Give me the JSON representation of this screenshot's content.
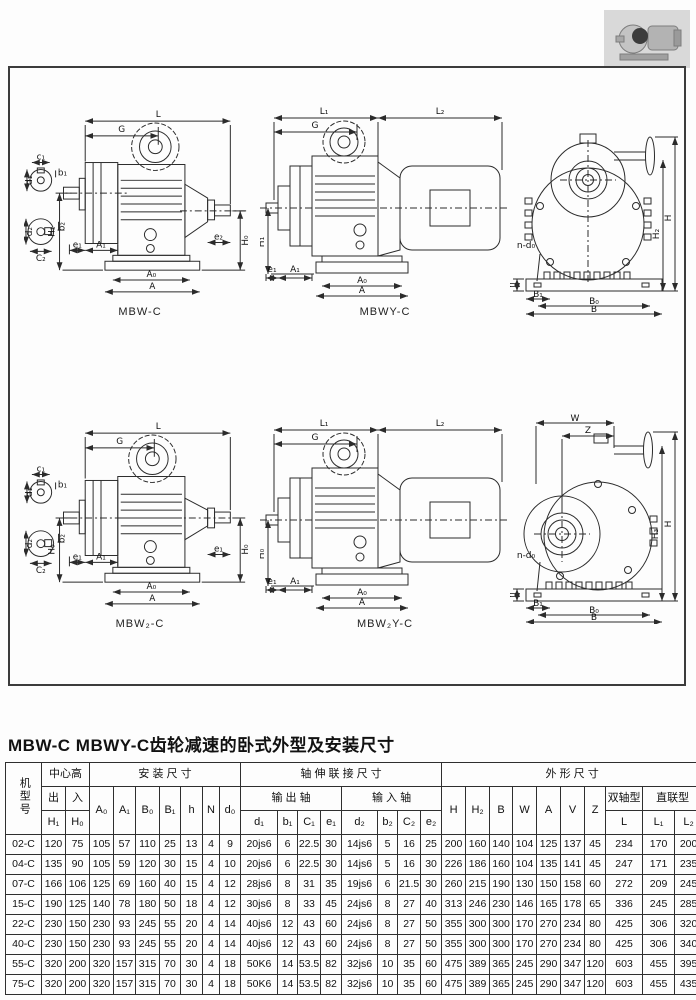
{
  "page": {
    "title": "MBW-C MBWY-C齿轮减速的卧式外型及安装尺寸"
  },
  "drawings": {
    "mbw": {
      "caption": "MBW-C",
      "dims": {
        "L": "L",
        "G": "G",
        "c1": "c₁",
        "b1": "b₁",
        "d1": "d₁",
        "C2": "C₂",
        "b2": "b₂",
        "d2": "d₂",
        "H1": "H₁",
        "H0": "H₀",
        "e1": "e₁",
        "A1": "A₁",
        "e2": "e₂",
        "A0": "A₀",
        "A": "A"
      }
    },
    "mbwy": {
      "caption": "MBWY-C",
      "dims": {
        "L1": "L₁",
        "L2": "L₂",
        "G": "G",
        "H1": "H₁",
        "e1": "e₁",
        "A1": "A₁",
        "A0": "A₀",
        "A": "A"
      }
    },
    "front_top": {
      "dims": {
        "ndo": "n-d₀",
        "h": "h",
        "B1": "B₁",
        "B0": "B₀",
        "B": "B",
        "H2": "H₂",
        "H": "H"
      }
    },
    "mbw2": {
      "caption": "MBW₂-C",
      "dims": {
        "L": "L",
        "G": "G",
        "c1": "c₁",
        "b1": "b₁",
        "d1": "d₁",
        "C2": "C₂",
        "b2": "b₂",
        "d2": "d₂",
        "H0L": "H₀",
        "H0R": "H₀",
        "e1": "e₁",
        "A1": "A₁",
        "e2": "e₁",
        "A0": "A₀",
        "A": "A"
      }
    },
    "mbwy2": {
      "caption": "MBW₂Y-C",
      "dims": {
        "L1": "L₁",
        "L2": "L₂",
        "G": "G",
        "H0": "H₀",
        "e1": "e₁",
        "A1": "A₁",
        "A0": "A₀",
        "A": "A"
      }
    },
    "front_bottom": {
      "dims": {
        "W": "W",
        "Z": "Z",
        "ndo": "n-d₀",
        "h": "h",
        "B1": "B₁",
        "B0": "B₀",
        "B": "B",
        "H3": "H₃",
        "H": "H"
      }
    }
  },
  "table": {
    "group_headers": {
      "model": "机型号",
      "center_height": "中心高",
      "mounting": "安 装 尺 寸",
      "shaft": "轴 伸 联 接 尺 寸",
      "outline": "外 形 尺 寸"
    },
    "sub_headers": {
      "out": "出",
      "in": "入",
      "output_shaft": "输 出 轴",
      "input_shaft": "输 入 轴",
      "double_shaft": "双轴型",
      "direct": "直联型"
    },
    "cols": {
      "H1": "H₁",
      "H0": "H₀",
      "A0": "A₀",
      "A1": "A₁",
      "B0": "B₀",
      "B1": "B₁",
      "h": "h",
      "N": "N",
      "d0": "d₀",
      "d1": "d₁",
      "b1": "b₁",
      "C1": "C₁",
      "e1": "e₁",
      "d2": "d₂",
      "b2": "b₂",
      "C2": "C₂",
      "e2": "e₂",
      "H": "H",
      "H2": "H₂",
      "B": "B",
      "W": "W",
      "A": "A",
      "V": "V",
      "Z": "Z",
      "L": "L",
      "L1": "L₁",
      "L2": "L₂"
    },
    "rows": [
      [
        "02-C",
        "120",
        "75",
        "105",
        "57",
        "110",
        "25",
        "13",
        "4",
        "9",
        "20js6",
        "6",
        "22.5",
        "30",
        "14js6",
        "5",
        "16",
        "25",
        "200",
        "160",
        "140",
        "104",
        "125",
        "137",
        "45",
        "234",
        "170",
        "200"
      ],
      [
        "04-C",
        "135",
        "90",
        "105",
        "59",
        "120",
        "30",
        "15",
        "4",
        "10",
        "20js6",
        "6",
        "22.5",
        "30",
        "14js6",
        "5",
        "16",
        "30",
        "226",
        "186",
        "160",
        "104",
        "135",
        "141",
        "45",
        "247",
        "171",
        "235"
      ],
      [
        "07-C",
        "166",
        "106",
        "125",
        "69",
        "160",
        "40",
        "15",
        "4",
        "12",
        "28js6",
        "8",
        "31",
        "35",
        "19js6",
        "6",
        "21.5",
        "30",
        "260",
        "215",
        "190",
        "130",
        "150",
        "158",
        "60",
        "272",
        "209",
        "245"
      ],
      [
        "15-C",
        "190",
        "125",
        "140",
        "78",
        "180",
        "50",
        "18",
        "4",
        "12",
        "30js6",
        "8",
        "33",
        "45",
        "24js6",
        "8",
        "27",
        "40",
        "313",
        "246",
        "230",
        "146",
        "165",
        "178",
        "65",
        "336",
        "245",
        "285"
      ],
      [
        "22-C",
        "230",
        "150",
        "230",
        "93",
        "245",
        "55",
        "20",
        "4",
        "14",
        "40js6",
        "12",
        "43",
        "60",
        "24js6",
        "8",
        "27",
        "50",
        "355",
        "300",
        "300",
        "170",
        "270",
        "234",
        "80",
        "425",
        "306",
        "320"
      ],
      [
        "40-C",
        "230",
        "150",
        "230",
        "93",
        "245",
        "55",
        "20",
        "4",
        "14",
        "40js6",
        "12",
        "43",
        "60",
        "24js6",
        "8",
        "27",
        "50",
        "355",
        "300",
        "300",
        "170",
        "270",
        "234",
        "80",
        "425",
        "306",
        "340"
      ],
      [
        "55-C",
        "320",
        "200",
        "320",
        "157",
        "315",
        "70",
        "30",
        "4",
        "18",
        "50K6",
        "14",
        "53.5",
        "82",
        "32js6",
        "10",
        "35",
        "60",
        "475",
        "389",
        "365",
        "245",
        "290",
        "347",
        "120",
        "603",
        "455",
        "395"
      ],
      [
        "75-C",
        "320",
        "200",
        "320",
        "157",
        "315",
        "70",
        "30",
        "4",
        "18",
        "50K6",
        "14",
        "53.5",
        "82",
        "32js6",
        "10",
        "35",
        "60",
        "475",
        "389",
        "365",
        "245",
        "290",
        "347",
        "120",
        "603",
        "455",
        "435"
      ]
    ]
  }
}
